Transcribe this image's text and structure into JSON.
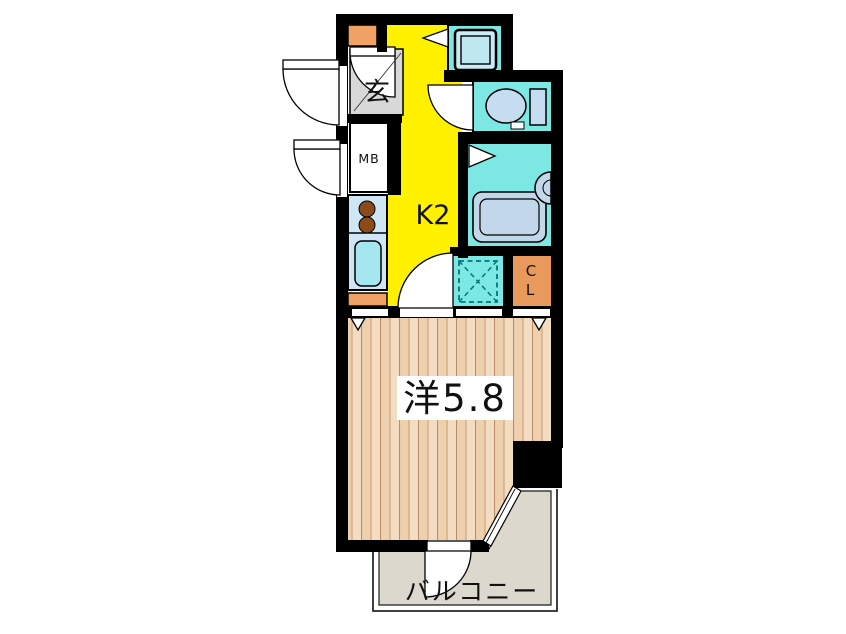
{
  "floorplan": {
    "rooms": {
      "entrance": {
        "label": "玄"
      },
      "meter_box": {
        "label": "MB"
      },
      "kitchen": {
        "label": "K2"
      },
      "closet": {
        "letters": [
          "C",
          "L"
        ]
      },
      "western_room": {
        "label": "洋5.8"
      },
      "balcony": {
        "label": "バルコニー"
      }
    },
    "icons": {
      "washing_machine": "washing-machine-icon",
      "toilet": "toilet-icon",
      "bathtub": "bathtub-icon",
      "wash_basin": "wash-basin-icon",
      "stove_burners": "stove-burners-icon",
      "kitchen_sink": "kitchen-sink-icon",
      "washer_space": "washer-space-dashed-icon",
      "door_swing": "door-swing-arc-icon",
      "window_marker": "window-triangle-icon"
    },
    "colors": {
      "kitchen": "#FFF100",
      "wet_area": "#7DE8E3",
      "closet_orange": "#E9995C",
      "cabinet_orange": "#F0A164",
      "wood_floor": "#F3DCC2",
      "balcony_floor": "#DDD8CE",
      "entrance_floor": "#D8D8D8",
      "fixture_blue": "#C6DCF0",
      "counter_blue": "#CFE6F5",
      "wall": "#000000"
    }
  }
}
